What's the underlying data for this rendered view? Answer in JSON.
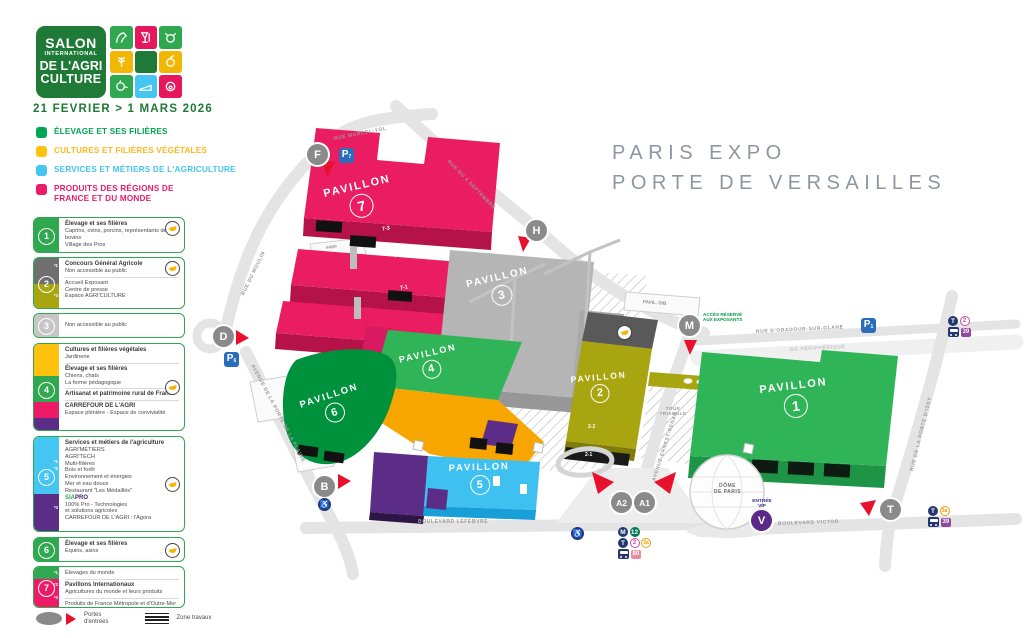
{
  "colors": {
    "green": "#00A651",
    "yellow": "#FFC20E",
    "cyan": "#45C5F2",
    "pink": "#EC1A67",
    "olive": "#A9A511",
    "purple": "#5B2D87",
    "map_green": "#2FB457",
    "gray": "#B5B5B5"
  },
  "logo": {
    "l1": "SALON",
    "l2": "INTERNATIONAL",
    "l3": "DE L'AGRI",
    "l4": "CULTURE",
    "dates": "21 FEVRIER > 1 MARS 2026"
  },
  "categories": [
    {
      "label": "ÉLEVAGE ET SES FILIÈRES"
    },
    {
      "label": "CULTURES ET FILIÈRES VÉGÉTALES"
    },
    {
      "label": "SERVICES ET MÉTIERS DE L'AGRICULTURE"
    },
    {
      "label": "PRODUITS DES RÉGIONS DE FRANCE ET DU MONDE"
    }
  ],
  "cards": {
    "c1": {
      "num": "1",
      "title": "Élevage et ses filières",
      "l1": "Caprins, ovins, porcins, représentants des bovins",
      "l2": "Village des Pros"
    },
    "c2": {
      "num": "2",
      "m1": "*1",
      "m2": "*3",
      "s1t": "Concours Général Agricole",
      "s1l": "Non accessible au public",
      "s2l1": "Accueil Exposant",
      "s2l2": "Centre de presse",
      "s2l3": "Espace AGRI'CULTURE"
    },
    "c3": {
      "num": "3",
      "l1": "Non accessible au public"
    },
    "c4": {
      "num": "4",
      "s1t": "Cultures et filières végétales",
      "s1l": "Jardinerie",
      "s2t": "Élevage et ses filières",
      "s2l1": "Chiens, chats",
      "s2l2": "La ferme pédagogique",
      "s3t": "Artisanat et patrimoine rural de France",
      "s4t": "CARREFOUR DE L'AGRI",
      "s4l": "Espace plénière - Espace de convivialité"
    },
    "c5": {
      "num": "5",
      "m1": "*1",
      "m2": "*2",
      "m3": "*3",
      "s1t": "Services et métiers de l'agriculture",
      "l1": "AGRI'MÉTIERS",
      "l2": "AGRI'TECH",
      "l3": "Multi-filières",
      "l4": "Bois et forêt",
      "l5": "Environnement et énergies",
      "l6": "Mer et eau douce",
      "l7": "Restaurant \"Les Médaillés\"",
      "sia": "SIA",
      "pro": "PRO",
      "p1": "100% Pro - Technologies",
      "p2": "et solutions agricoles",
      "p3": "CARREFOUR DE L'AGRI : l'Agora"
    },
    "c6": {
      "num": "6",
      "title": "Élevage et ses filières",
      "l1": "Équins, asins"
    },
    "c7": {
      "num": "7",
      "m1": "*1",
      "m2": "*2",
      "m3": "*3",
      "s1": "Élevages du monde",
      "s2t": "Pavillons Internationaux",
      "s2l": "Agricultures du monde et leurs produits",
      "s3": "Produits de France Métropole et d'Outre-Mer"
    }
  },
  "footer": {
    "gates1": "Portes",
    "gates2": "d'entrées",
    "works": "Zone travaux"
  },
  "map": {
    "title1": "PARIS EXPO",
    "title2": "PORTE DE VERSAILLES",
    "pavilion_word": "PAVILLON",
    "pavilions": {
      "p1": "1",
      "p2": "2",
      "p3": "3",
      "p4": "4",
      "p5": "5",
      "p6": "6",
      "p7": "7"
    },
    "sublabels": {
      "s73": "7-3",
      "s72": "7-2",
      "s71": "7-1",
      "s22": "2-2",
      "s21": "2-1"
    },
    "streets": {
      "marcel_yol": "RUE MARCEL-YOL",
      "septembre": "RUE DU 4 SEPTEMBRE",
      "moulin": "RUE DU MOULIN",
      "plaine": "AVENUE DE LA PORTE DE LA PLAINE",
      "lefebvre": "BOULEVARD LEFEBVRE",
      "victor": "BOULEVARD VICTOR",
      "oradour": "RUE D'ORADOUR-SUR-GLANE",
      "peripherique": "BD PÉRIPHÉRIQUE",
      "issy": "RUE DE LA PORTE D'ISSY",
      "renan": "AVENUE ERNEST-RENAN"
    },
    "gates": {
      "f": "F",
      "d": "D",
      "b": "B",
      "h": "H",
      "m": "M",
      "a2": "A2",
      "a1": "A1",
      "t": "T",
      "v": "V"
    },
    "parking": {
      "p": "P",
      "n7": "7",
      "n6": "6",
      "n1": "1"
    },
    "pois": {
      "dome1": "DÔME",
      "dome2": "DE PARIS",
      "tour1": "TOUR",
      "tour2": "TRIANGLE",
      "pavdb": "PAVIL. D/B",
      "expo": "expo",
      "acces1": "ACCÈS RÉSERVÉ",
      "acces2": "AUX EXPOSANTS",
      "vip1": "ENTRÉE",
      "vip2": "VIP"
    },
    "transit": {
      "metro": "M",
      "l12": "12",
      "tram": "T",
      "t2": "2",
      "t3a": "3a",
      "b39": "39",
      "b80": "80",
      "wheelchair": "♿"
    }
  }
}
